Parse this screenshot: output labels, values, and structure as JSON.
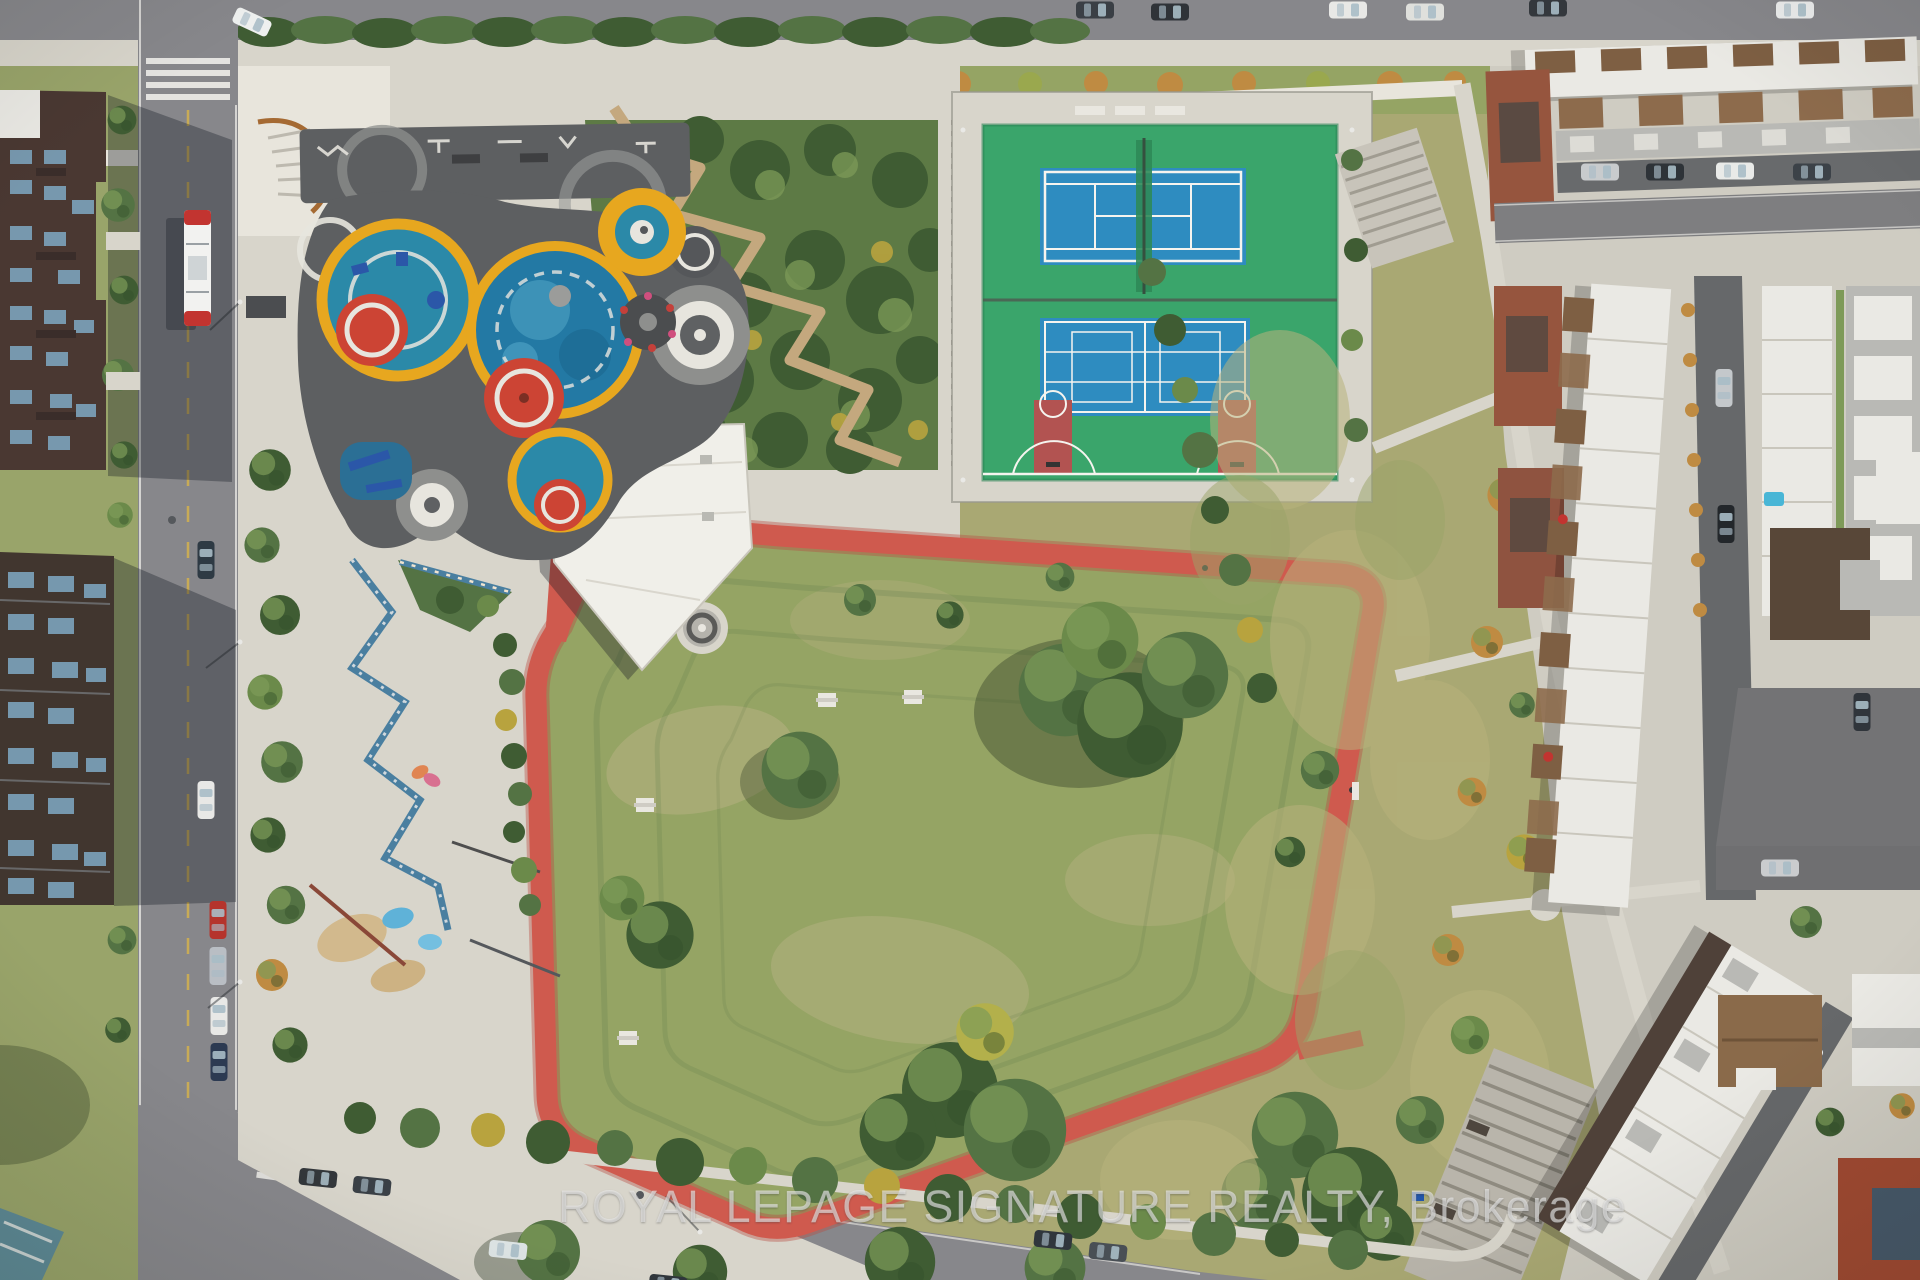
{
  "image": {
    "type": "aerial-drone-photo",
    "description": "Aerial view of an urban park: colourful circular playground and splash pad, outdoor fitness pad, tennis court and multi-use basketball court, red walking loop around a grass field with picnic tables, skate plaza with graffiti ledges, surrounded by streets, a transit bus, parked cars, mid-rise apartments on the left and modern townhouse rows on the right."
  },
  "watermark": {
    "text": "ROYAL LEPAGE SIGNATURE REALTY, Brokerage"
  },
  "palette": {
    "concrete": "#d8d5cb",
    "concrete_bright": "#e8e5dc",
    "asphalt": "#87878b",
    "asphalt_dark": "#68686c",
    "grass": "#95a464",
    "meadow": "#a9a873",
    "grass_dry": "#b6b181",
    "tree_dark": "#3f5c33",
    "tree_mid": "#547344",
    "tree_light": "#7d9b58",
    "autumn": "#bf8b42",
    "track_red": "#cf5a4e",
    "court_green": "#3aa56b",
    "court_blue": "#2e8cc0",
    "key_red": "#b25351",
    "play_teal": "#2b89a8",
    "play_water": "#2379a4",
    "play_yellow": "#e7a71f",
    "play_red": "#cc4434",
    "pad_dark": "#5d5f61",
    "ring_gray": "#8e8f8d",
    "ring_white": "#e7e5de",
    "roof_white": "#eae9e4",
    "roof_gray": "#b9b9b5",
    "wood_brown": "#7e5f43",
    "brick": "#96553e",
    "building_dark": "#4a3832",
    "glass": "#7ca3bc",
    "line_white": "#f5f4ef",
    "boardwalk": "#c4a87e",
    "bus_red": "#c23430",
    "watermark": "rgba(238,238,238,0.55)"
  },
  "features": [
    "tennis-court",
    "basketball-multiuse-court",
    "splash-pad-playground",
    "outdoor-fitness-pad",
    "red-walking-loop",
    "grass-field",
    "picnic-tables",
    "park-pavilion-building",
    "skate-plaza",
    "boardwalk-garden",
    "transit-bus",
    "parked-cars",
    "apartment-buildings",
    "townhouse-rows",
    "streets",
    "walking-paths",
    "meadow",
    "trees"
  ]
}
